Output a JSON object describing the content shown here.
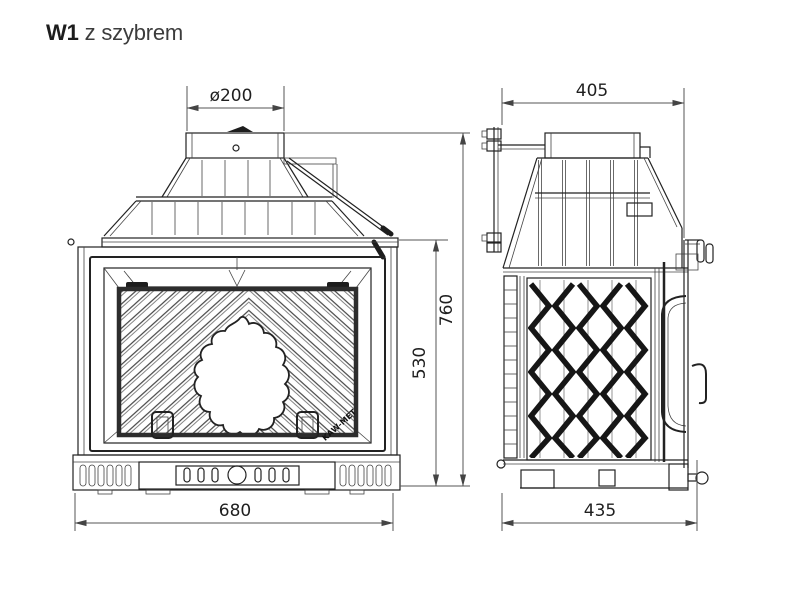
{
  "title": {
    "model": "W1",
    "variant": "z szybrem"
  },
  "drawing": {
    "kind": "fireplace-insert-technical-drawing",
    "views": {
      "left": "front-view",
      "right": "side-view"
    },
    "logo_text": "KAW-MET",
    "dimensions": {
      "flue_diameter": "ø200",
      "side_top_width": "405",
      "overall_height": "760",
      "firebox_height": "530",
      "front_width": "680",
      "side_bottom_depth": "435"
    },
    "colors": {
      "line": "#222222",
      "dimension_line": "#555555",
      "text": "#1f1f1f",
      "background": "#ffffff"
    }
  }
}
